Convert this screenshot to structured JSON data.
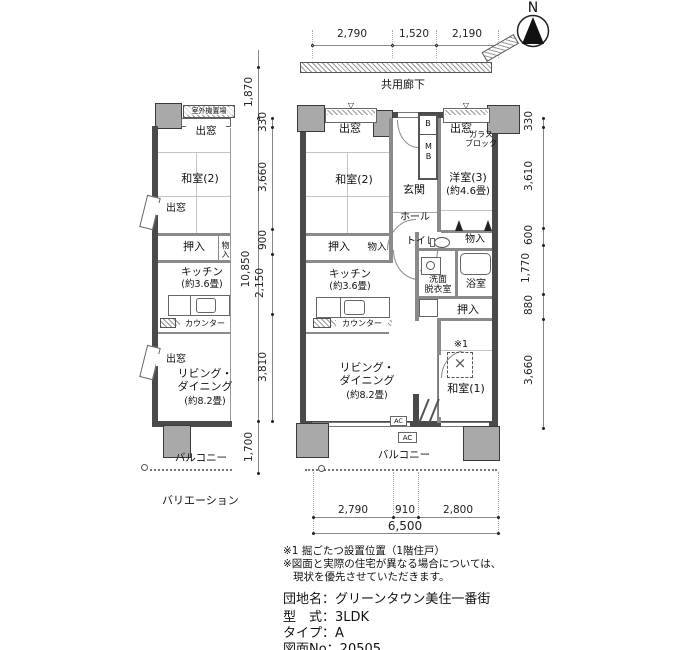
{
  "compass": {
    "label": "N"
  },
  "corridor": {
    "label": "共用廊下"
  },
  "markers": {
    "triangle": "▽",
    "cross": "×"
  },
  "dims": {
    "top": [
      "2,790",
      "1,520",
      "2,190"
    ],
    "left_upper": "1,870",
    "left_total": "10,850",
    "left_segments": [
      "330",
      "3,660",
      "900",
      "2,150",
      "3,810"
    ],
    "left_lower": "1,700",
    "right_segments": [
      "330",
      "3,610",
      "600",
      "1,770",
      "880",
      "3,660"
    ],
    "bottom_segments": [
      "2,790",
      "910",
      "2,800"
    ],
    "bottom_total": "6,500"
  },
  "main_plan": {
    "bay_window_left": "出窓",
    "bay_window_right": "出窓",
    "glass_block_l1": "ガラス",
    "glass_block_l2": "ブロック",
    "box_b": "B",
    "box_mb": "MB",
    "entrance": "玄関",
    "washitsu2": "和室(2)",
    "yoshitsu3": "洋室(3)",
    "yoshitsu3_size": "(約4.6畳)",
    "hall": "ホール",
    "toilet": "トイレ",
    "storage_top_right": "物入",
    "closet_left": "押入",
    "storage_left": "物入",
    "kitchen": "キッチン",
    "kitchen_size": "(約3.6畳)",
    "washroom_l1": "洗面",
    "washroom_l2": "脱衣室",
    "bath": "浴室",
    "laundry": "洗",
    "closet_right": "押入",
    "note_ref": "※1",
    "washitsu1": "和室(1)",
    "living_l1": "リビング・",
    "living_l2": "ダイニング",
    "living_size": "(約8.2畳)",
    "counter": "カウンター",
    "balcony": "バルコニー",
    "ac": "AC"
  },
  "variation_plan": {
    "outdoor_unit": "室外機置場",
    "bay_window_top": "出窓",
    "bay_window_mid": "出窓",
    "bay_window_lower": "出窓",
    "washitsu2": "和室(2)",
    "closet": "押入",
    "storage": "物入",
    "kitchen": "キッチン",
    "kitchen_size": "(約3.6畳)",
    "counter": "カウンター",
    "living_l1": "リビング・",
    "living_l2": "ダイニング",
    "living_size": "(約8.2畳)",
    "balcony": "バルコニー",
    "caption": "バリエーション"
  },
  "notes": [
    "※1 掘ごたつ設置位置（1階住戸）",
    "※図面と実際の住宅が異なる場合については、",
    "現状を優先させていただきます。"
  ],
  "info": [
    "団地名：グリーンタウン美住一番街",
    "型　式：3LDK",
    "タイプ：A",
    "図面No：20505"
  ]
}
